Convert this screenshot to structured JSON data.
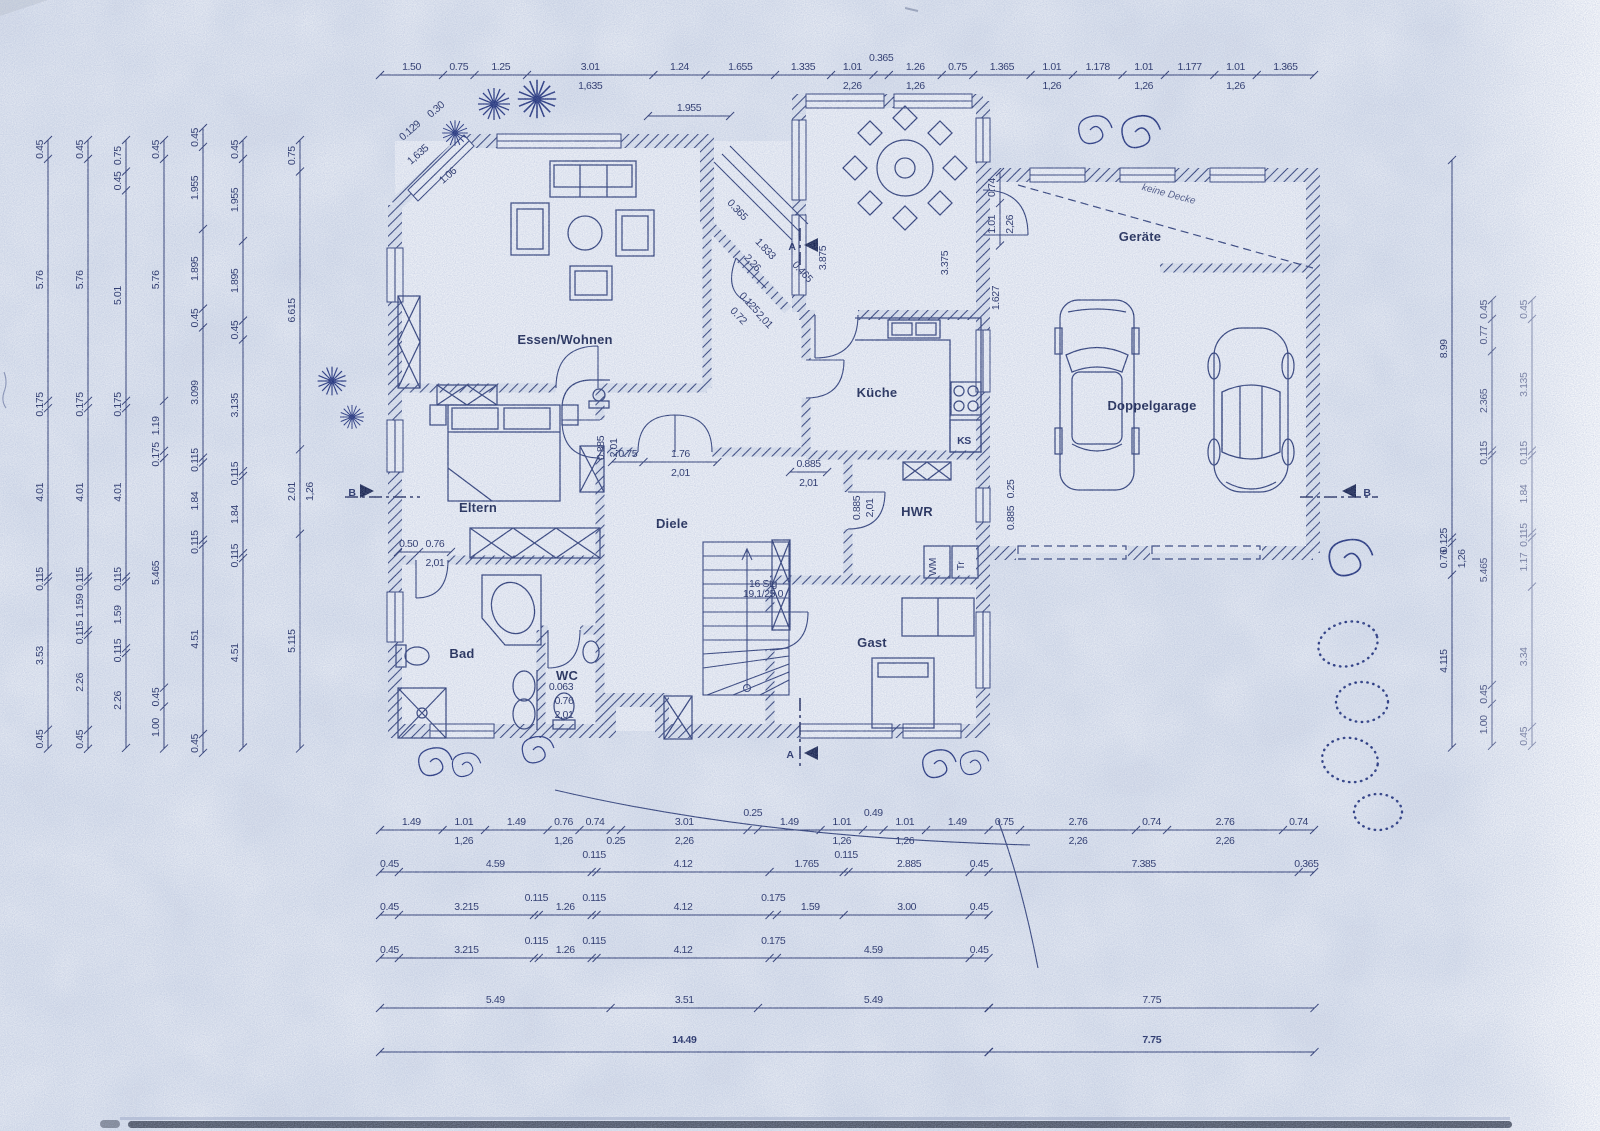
{
  "plan": {
    "rooms": [
      {
        "label": "Essen/Wohnen",
        "x": 565,
        "y": 344
      },
      {
        "label": "Eltern",
        "x": 478,
        "y": 512
      },
      {
        "label": "Bad",
        "x": 462,
        "y": 658
      },
      {
        "label": "WC",
        "x": 567,
        "y": 680
      },
      {
        "label": "Diele",
        "x": 672,
        "y": 528
      },
      {
        "label": "Küche",
        "x": 877,
        "y": 397
      },
      {
        "label": "HWR",
        "x": 917,
        "y": 516
      },
      {
        "label": "Gast",
        "x": 872,
        "y": 647
      },
      {
        "label": "Geräte",
        "x": 1140,
        "y": 241
      },
      {
        "label": "Doppelgarage",
        "x": 1152,
        "y": 410
      }
    ],
    "annotations": [
      {
        "label": "keine Decke",
        "x": 1168,
        "y": 197,
        "rot": 15,
        "cls": "hand"
      },
      {
        "label": "KS",
        "x": 964,
        "y": 444,
        "size": 11,
        "bold": true
      },
      {
        "label": "WM",
        "x": 936,
        "y": 567,
        "rot": -90,
        "size": 9
      },
      {
        "label": "Tr",
        "x": 964,
        "y": 566,
        "rot": -90,
        "size": 9
      },
      {
        "label": "16 Stg",
        "x": 763,
        "y": 587,
        "size": 8
      },
      {
        "label": "19,1/25,0",
        "x": 763,
        "y": 597,
        "size": 8
      },
      {
        "label": "A",
        "x": 792,
        "y": 250,
        "size": 13,
        "bold": true
      },
      {
        "label": "A",
        "x": 790,
        "y": 758,
        "size": 13,
        "bold": true
      },
      {
        "label": "B",
        "x": 352,
        "y": 496,
        "size": 10,
        "bold": true
      },
      {
        "label": "B",
        "x": 1367,
        "y": 496,
        "size": 10,
        "bold": true
      }
    ],
    "totals": {
      "house_width": "14.49",
      "garage_width": "7.75"
    },
    "scale_px_per_m": 42,
    "dimension_chains": [
      {
        "id": "top",
        "o": "h",
        "x": 380,
        "y": 75,
        "segs": [
          {
            "v": "1.50"
          },
          {
            "v": "0.75"
          },
          {
            "v": "1.25"
          },
          {
            "v": "3.01",
            "s": "1,635"
          },
          {
            "v": "1.24"
          },
          {
            "v": "1.655"
          },
          {
            "v": "1.335"
          },
          {
            "v": "1.01",
            "s": "2,26"
          },
          {
            "v": "0.365",
            "dy": -9
          },
          {
            "v": "1.26",
            "s": "1,26"
          },
          {
            "v": "0.75"
          },
          {
            "v": "1.365"
          },
          {
            "v": "1.01",
            "s": "1,26"
          },
          {
            "v": "1.178"
          },
          {
            "v": "1.01",
            "s": "1,26"
          },
          {
            "v": "1.177"
          },
          {
            "v": "1.01",
            "s": "1,26"
          },
          {
            "v": "1.365"
          }
        ]
      },
      {
        "id": "wg-top",
        "o": "h",
        "x": 648,
        "y": 116,
        "segs": [
          {
            "v": "1.955"
          }
        ]
      },
      {
        "id": "bottom-1",
        "o": "h",
        "x": 380,
        "y": 830,
        "segs": [
          {
            "v": "1.49"
          },
          {
            "v": "1.01",
            "s": "1,26"
          },
          {
            "v": "1.49"
          },
          {
            "v": "0.76",
            "s": "1,26"
          },
          {
            "v": "0.74"
          },
          {
            "v": "0.25",
            "b": true
          },
          {
            "v": "3.01",
            "s": "2,26"
          },
          {
            "v": "0.25",
            "dy": -9
          },
          {
            "v": "1.49"
          },
          {
            "v": "1.01",
            "s": "1,26"
          },
          {
            "v": "0.49",
            "dy": -9
          },
          {
            "v": "1.01",
            "s": "1,26"
          },
          {
            "v": "1.49"
          },
          {
            "v": "0.75"
          },
          {
            "v": "2.76",
            "s": "2,26"
          },
          {
            "v": "0.74"
          },
          {
            "v": "2.76",
            "s": "2,26"
          },
          {
            "v": "0.74"
          }
        ]
      },
      {
        "id": "bottom-2",
        "o": "h",
        "x": 380,
        "y": 872,
        "segs": [
          {
            "v": "0.45"
          },
          {
            "v": "4.59"
          },
          {
            "v": "0.115",
            "dy": -9
          },
          {
            "v": "4.12"
          },
          {
            "v": "1.765"
          },
          {
            "v": "0.115",
            "dy": -9
          },
          {
            "v": "2.885"
          },
          {
            "v": "0.45"
          },
          {
            "v": "7.385"
          },
          {
            "v": "0.365"
          }
        ]
      },
      {
        "id": "bottom-3",
        "o": "h",
        "x": 380,
        "y": 915,
        "segs": [
          {
            "v": "0.45"
          },
          {
            "v": "3.215"
          },
          {
            "v": "0.115",
            "dy": -9
          },
          {
            "v": "1.26"
          },
          {
            "v": "0.115",
            "dy": -9
          },
          {
            "v": "4.12"
          },
          {
            "v": "0.175",
            "dy": -9
          },
          {
            "v": "1.59"
          },
          {
            "v": "3.00"
          },
          {
            "v": "0.45"
          }
        ]
      },
      {
        "id": "bottom-4",
        "o": "h",
        "x": 380,
        "y": 958,
        "segs": [
          {
            "v": "0.45"
          },
          {
            "v": "3.215"
          },
          {
            "v": "0.115",
            "dy": -9
          },
          {
            "v": "1.26"
          },
          {
            "v": "0.115",
            "dy": -9
          },
          {
            "v": "4.12"
          },
          {
            "v": "0.175",
            "dy": -9
          },
          {
            "v": "4.59"
          },
          {
            "v": "0.45"
          }
        ]
      },
      {
        "id": "bottom-5a",
        "o": "h",
        "x": 380,
        "y": 1008,
        "segs": [
          {
            "v": "5.49"
          },
          {
            "v": "3.51"
          },
          {
            "v": "5.49"
          }
        ]
      },
      {
        "id": "bottom-5b",
        "o": "h",
        "x": 989,
        "y": 1008,
        "segs": [
          {
            "v": "7.75"
          }
        ]
      },
      {
        "id": "bottom-6a",
        "o": "h",
        "x": 380,
        "y": 1052,
        "segs": [
          {
            "v": "14.49",
            "big": true
          }
        ]
      },
      {
        "id": "bottom-6b",
        "o": "h",
        "x": 989,
        "y": 1052,
        "segs": [
          {
            "v": "7.75",
            "big": true
          }
        ]
      },
      {
        "id": "left-1",
        "o": "v",
        "x": 48,
        "y": 140,
        "segs": [
          {
            "v": "0.45"
          },
          {
            "v": "5.76"
          },
          {
            "v": "0.175"
          },
          {
            "v": "4.01"
          },
          {
            "v": "0.115"
          },
          {
            "v": "3.53"
          },
          {
            "v": "0.45"
          }
        ]
      },
      {
        "id": "left-2",
        "o": "v",
        "x": 88,
        "y": 140,
        "segs": [
          {
            "v": "0.45"
          },
          {
            "v": "5.76"
          },
          {
            "v": "0.175"
          },
          {
            "v": "4.01"
          },
          {
            "v": "0.115"
          },
          {
            "v": "1.159"
          },
          {
            "v": "0.115"
          },
          {
            "v": "2.26"
          },
          {
            "v": "0.45"
          }
        ]
      },
      {
        "id": "left-3",
        "o": "v",
        "x": 126,
        "y": 140,
        "segs": [
          {
            "v": "0.75"
          },
          {
            "v": "0.45"
          },
          {
            "v": "5.01"
          },
          {
            "v": "0.175"
          },
          {
            "v": "4.01"
          },
          {
            "v": "0.115"
          },
          {
            "v": "1.59"
          },
          {
            "v": "0.115"
          },
          {
            "v": "2.26"
          }
        ]
      },
      {
        "id": "left-4",
        "o": "v",
        "x": 164,
        "y": 140,
        "segs": [
          {
            "v": "0.45"
          },
          {
            "v": "5.76"
          },
          {
            "v": "1.19"
          },
          {
            "v": "0.175"
          },
          {
            "v": "5.465"
          },
          {
            "v": "0.45"
          },
          {
            "v": "1.00"
          }
        ]
      },
      {
        "id": "left-5",
        "o": "v",
        "x": 203,
        "y": 128,
        "segs": [
          {
            "v": "0.45"
          },
          {
            "v": "1.955"
          },
          {
            "v": "1.895"
          },
          {
            "v": "0.45"
          },
          {
            "v": "3.099"
          },
          {
            "v": "0.115"
          },
          {
            "v": "1.84"
          },
          {
            "v": "0.115"
          },
          {
            "v": "4.51"
          },
          {
            "v": "0.45"
          }
        ]
      },
      {
        "id": "left-6",
        "o": "v",
        "x": 243,
        "y": 140,
        "segs": [
          {
            "v": "0.45"
          },
          {
            "v": "1.955"
          },
          {
            "v": "1.895"
          },
          {
            "v": "0.45"
          },
          {
            "v": "3.135"
          },
          {
            "v": "0.115"
          },
          {
            "v": "1.84"
          },
          {
            "v": "0.115"
          },
          {
            "v": "4.51"
          }
        ]
      },
      {
        "id": "left-7",
        "o": "v",
        "x": 300,
        "y": 140,
        "segs": [
          {
            "v": "0.75"
          },
          {
            "v": "6.615"
          },
          {
            "v": "2.01",
            "s": "1,26"
          },
          {
            "v": "5.115"
          }
        ]
      },
      {
        "id": "right-1",
        "o": "v",
        "x": 1452,
        "y": 160,
        "segs": [
          {
            "v": "8.99"
          },
          {
            "v": "0.125"
          },
          {
            "v": "0.76",
            "s": "1,26"
          },
          {
            "v": "4.115"
          }
        ]
      },
      {
        "id": "right-2",
        "o": "v",
        "x": 1492,
        "y": 300,
        "segs": [
          {
            "v": "0.45"
          },
          {
            "v": "0.77"
          },
          {
            "v": "2.365"
          },
          {
            "v": "0.115"
          },
          {
            "v": "5.465"
          },
          {
            "v": "0.45"
          },
          {
            "v": "1.00"
          }
        ]
      },
      {
        "id": "right-3",
        "o": "v",
        "x": 1532,
        "y": 300,
        "segs": [
          {
            "v": "0.45"
          },
          {
            "v": "3.135"
          },
          {
            "v": "0.115"
          },
          {
            "v": "1.84"
          },
          {
            "v": "0.115"
          },
          {
            "v": "1.17"
          },
          {
            "v": "3.34"
          },
          {
            "v": "0.45"
          }
        ]
      },
      {
        "id": "diele-top",
        "o": "h",
        "x": 612,
        "y": 462,
        "segs": [
          {
            "v": "0.75"
          },
          {
            "v": "1.76",
            "s": "2,01"
          }
        ]
      },
      {
        "id": "bad-door",
        "o": "h",
        "x": 398,
        "y": 552,
        "segs": [
          {
            "v": "0.50"
          },
          {
            "v": "0.76",
            "s": "2,01"
          }
        ]
      },
      {
        "id": "kueche-door",
        "o": "h",
        "x": 790,
        "y": 472,
        "segs": [
          {
            "v": "0.885",
            "s": "2,01"
          }
        ]
      },
      {
        "id": "wg-right",
        "o": "v",
        "x": 1000,
        "y": 172,
        "segs": [
          {
            "v": "0.74"
          },
          {
            "v": "1.01",
            "s": "2,26"
          }
        ]
      }
    ],
    "free_dimensions": [
      {
        "t": "3.875",
        "x": 826,
        "y": 258,
        "rot": -90
      },
      {
        "t": "3.375",
        "x": 948,
        "y": 263,
        "rot": -90
      },
      {
        "t": "1.627",
        "x": 999,
        "y": 298,
        "rot": -90
      },
      {
        "t": "0.885",
        "x": 604,
        "y": 448,
        "rot": -90
      },
      {
        "t": "2,01",
        "x": 617,
        "y": 448,
        "rot": -90
      },
      {
        "t": "0.885",
        "x": 860,
        "y": 508,
        "rot": -90
      },
      {
        "t": "2,01",
        "x": 873,
        "y": 508,
        "rot": -90
      },
      {
        "t": "0.25",
        "x": 1014,
        "y": 489,
        "rot": -90
      },
      {
        "t": "0.885",
        "x": 1014,
        "y": 518,
        "rot": -90
      },
      {
        "t": "0.063",
        "x": 561,
        "y": 690
      },
      {
        "t": "0.76",
        "x": 564,
        "y": 704
      },
      {
        "t": "2,01",
        "x": 564,
        "y": 718
      },
      {
        "t": "0.30",
        "x": 438,
        "y": 112,
        "rot": -41
      },
      {
        "t": "0.129",
        "x": 412,
        "y": 133,
        "rot": -41
      },
      {
        "t": "1,635",
        "x": 420,
        "y": 157,
        "rot": -41
      },
      {
        "t": "1.06",
        "x": 450,
        "y": 178,
        "rot": -41
      },
      {
        "t": "0.365",
        "x": 735,
        "y": 212,
        "rot": 47
      },
      {
        "t": "1.833",
        "x": 763,
        "y": 251,
        "rot": 47
      },
      {
        "t": "2,26",
        "x": 750,
        "y": 265,
        "rot": 47
      },
      {
        "t": "0.465",
        "x": 800,
        "y": 274,
        "rot": 47
      },
      {
        "t": "0.125",
        "x": 747,
        "y": 305,
        "rot": 47
      },
      {
        "t": "0.72",
        "x": 736,
        "y": 318,
        "rot": 47
      },
      {
        "t": "2,01",
        "x": 762,
        "y": 322,
        "rot": 47
      }
    ],
    "colors": {
      "ink": "#26336c",
      "paper": "#e9edf4"
    }
  }
}
